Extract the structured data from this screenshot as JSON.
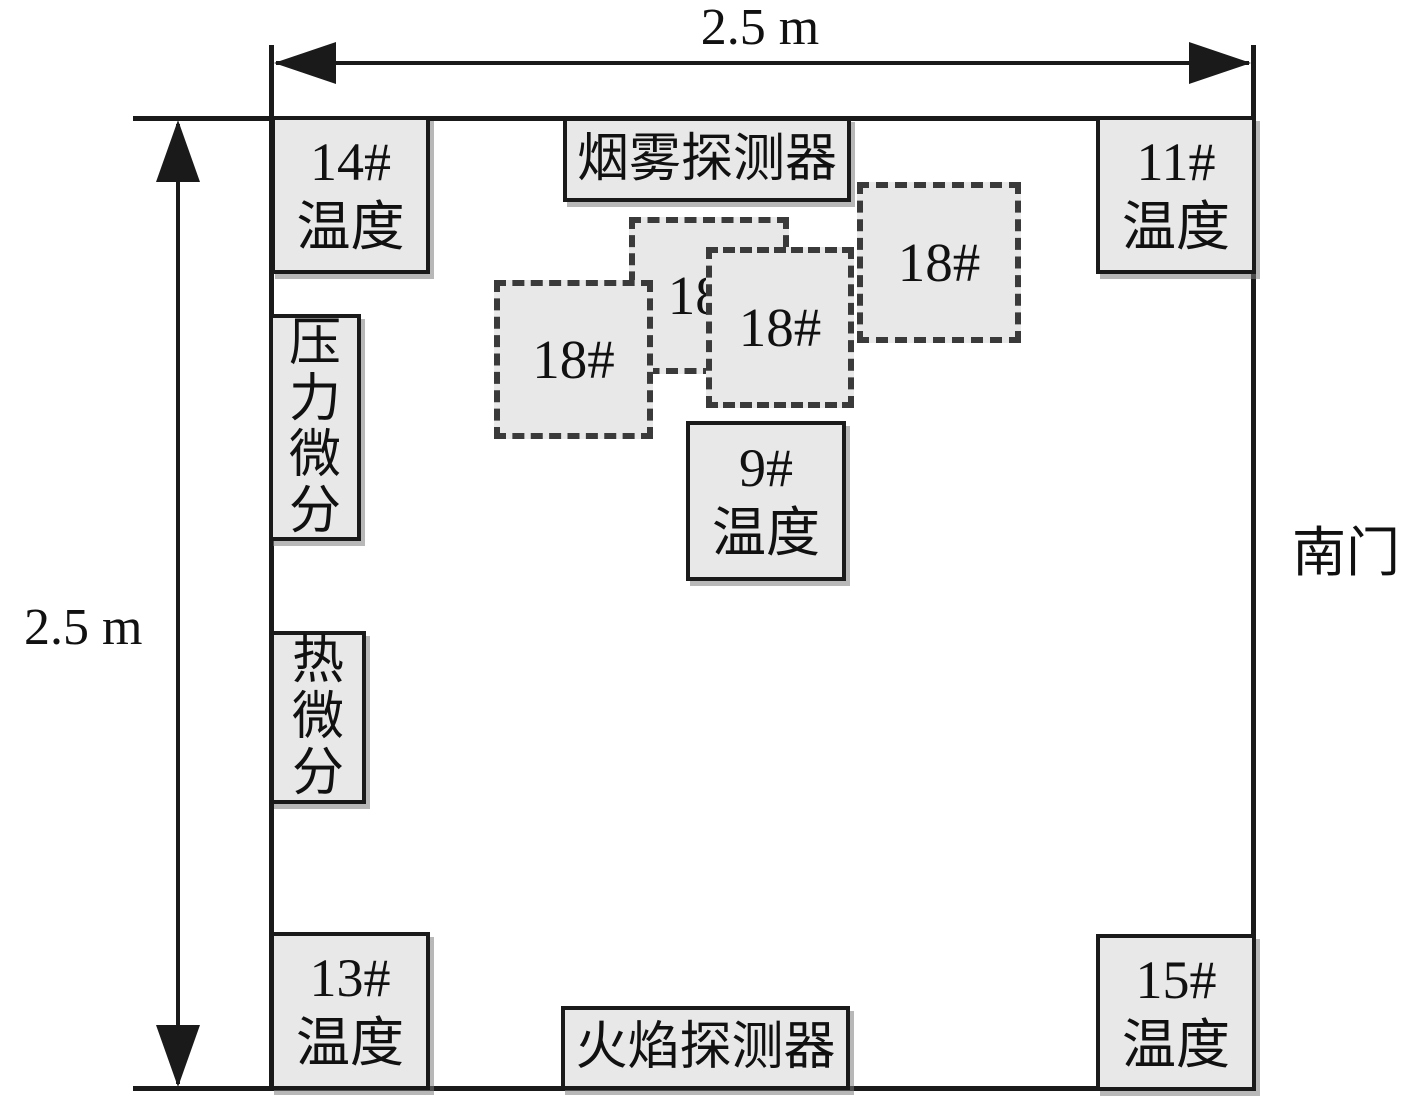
{
  "diagram": {
    "dimensions": {
      "width_label": "2.5 m",
      "height_label": "2.5 m"
    },
    "door_label": "南门",
    "detectors": {
      "smoke": "烟雾探测器",
      "flame": "火焰探测器"
    },
    "thermocouples": {
      "t14": {
        "id": "14#",
        "type": "温度"
      },
      "t11": {
        "id": "11#",
        "type": "温度"
      },
      "t9": {
        "id": "9#",
        "type": "温度"
      },
      "t13": {
        "id": "13#",
        "type": "温度"
      },
      "t15": {
        "id": "15#",
        "type": "温度"
      }
    },
    "gauges": {
      "pressure_diff": {
        "chars": [
          "压",
          "力",
          "微",
          "分"
        ]
      },
      "thermal_diff": {
        "chars": [
          "热",
          "微",
          "分"
        ]
      }
    },
    "samples": [
      {
        "label": "18#"
      },
      {
        "label": "18#"
      },
      {
        "label": "18#"
      },
      {
        "label": "18#"
      }
    ]
  }
}
